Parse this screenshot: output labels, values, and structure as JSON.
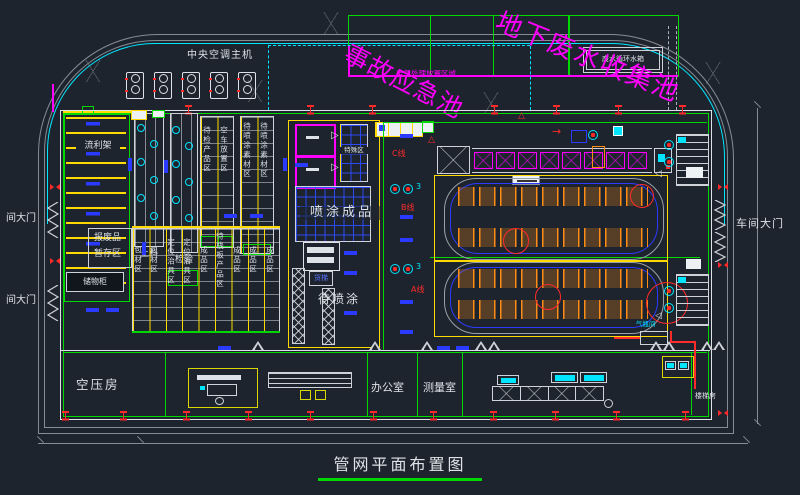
{
  "colors": {
    "bg": "#1e242d",
    "green": "#00d900",
    "cyan": "#00e5ff",
    "yellow": "#ffd900",
    "magenta": "#ff00ff",
    "red": "#ff2b2b",
    "blue": "#2a3bff",
    "orange": "#ff8c14",
    "white": "#dde2e8",
    "gray": "#9aa0a8"
  },
  "title": "管网平面布置图",
  "pools": {
    "accident": "事故应急池",
    "underground": "地下废水收集池",
    "gas_area": "废气处理放置区域",
    "tank": "废水循环水箱"
  },
  "hvac": {
    "label": "中央空调主机"
  },
  "gates": {
    "left_upper": "间大门",
    "left_lower": "间大门",
    "right": "车间大门"
  },
  "zones": {
    "flow_rack": "流利架",
    "loading": "上料",
    "inspection": "检验",
    "col_wait_inspection": "待检产品区",
    "col_empty_cart": "空车放置区",
    "col_material_a": "待喷涂素材区",
    "col_material_b": "待喷涂素材区",
    "scrap_line1": "报废品",
    "scrap_line2": "暂存区",
    "cabinet": "储物柜",
    "storage_columns": [
      "包材区",
      "包材区",
      "定位治具区",
      "定位治具区",
      "成品区",
      "待栈板产品区",
      "成品区",
      "成品区",
      "成品区"
    ],
    "painted": "喷涂成品",
    "to_paint": "待喷涂",
    "special": "特殊区",
    "lift": "货梯",
    "gas_room": "气瓶间",
    "stair_room": "楼梯房"
  },
  "lines": {
    "a": "A线",
    "b": "B线",
    "c": "C线",
    "fan_count": "3"
  },
  "rooms": {
    "compressor": "空压房",
    "office": "办公室",
    "measure": "测量室"
  },
  "glyphs": {
    "tri_right": "▷",
    "tri_left": "◁",
    "tri_up": "△",
    "arrow_right": "→"
  }
}
